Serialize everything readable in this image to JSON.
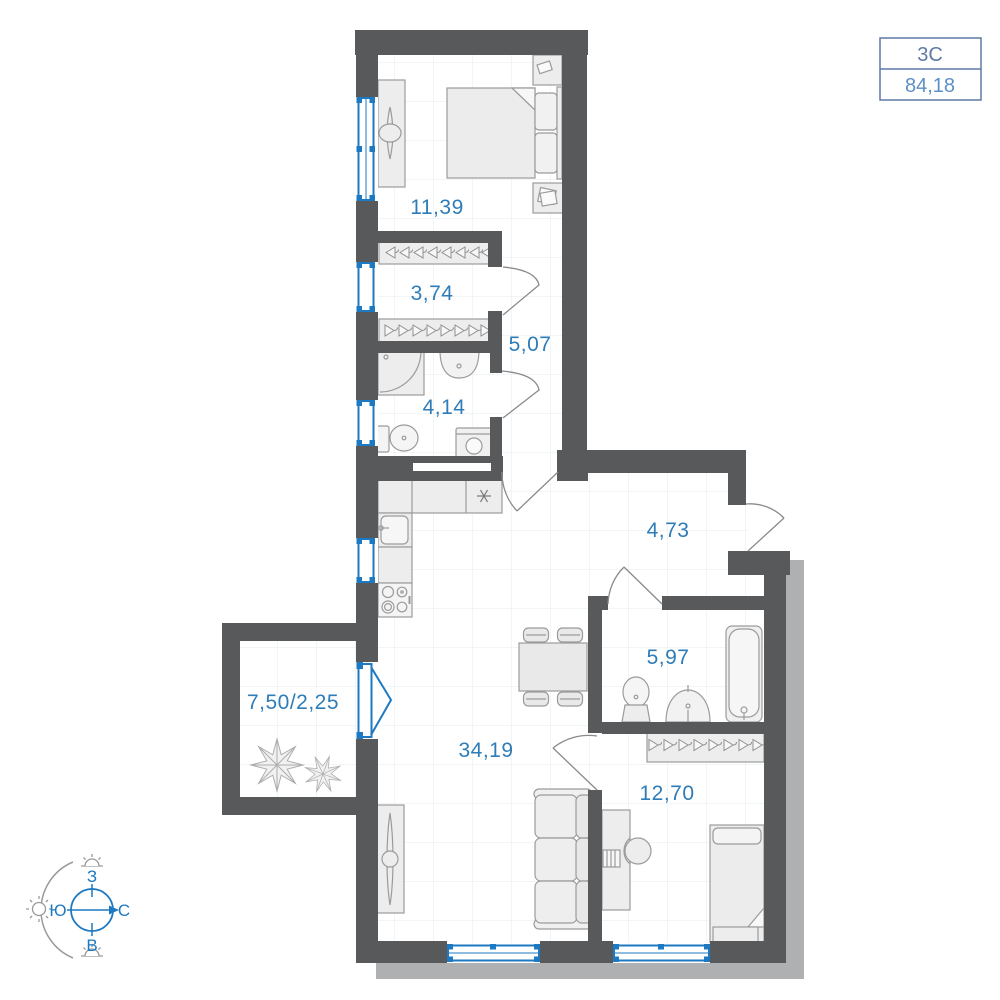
{
  "plan": {
    "info_box": {
      "type_label": "3С",
      "area_label": "84,18"
    },
    "rooms": [
      {
        "name": "bedroom",
        "area": "11,39"
      },
      {
        "name": "wardrobe",
        "area": "3,74"
      },
      {
        "name": "corridor",
        "area": "5,07"
      },
      {
        "name": "bathroom-small",
        "area": "4,14"
      },
      {
        "name": "hallway",
        "area": "4,73"
      },
      {
        "name": "bathroom-large",
        "area": "5,97"
      },
      {
        "name": "kitchen-living",
        "area": "34,19"
      },
      {
        "name": "bedroom-second",
        "area": "12,70"
      },
      {
        "name": "balcony",
        "area": "7,50/2,25"
      }
    ],
    "compass": {
      "west": "З",
      "south": "Ю",
      "north": "С",
      "east": "В"
    },
    "colors": {
      "wall": "#58595b",
      "accent_blue": "#1d79c2",
      "label_blue": "#2e7cb8",
      "box_border": "#5e7aa5",
      "furniture_stroke": "#9b9b9b",
      "grid": "#e6ebee",
      "shadow": "#aeb0b2"
    }
  }
}
